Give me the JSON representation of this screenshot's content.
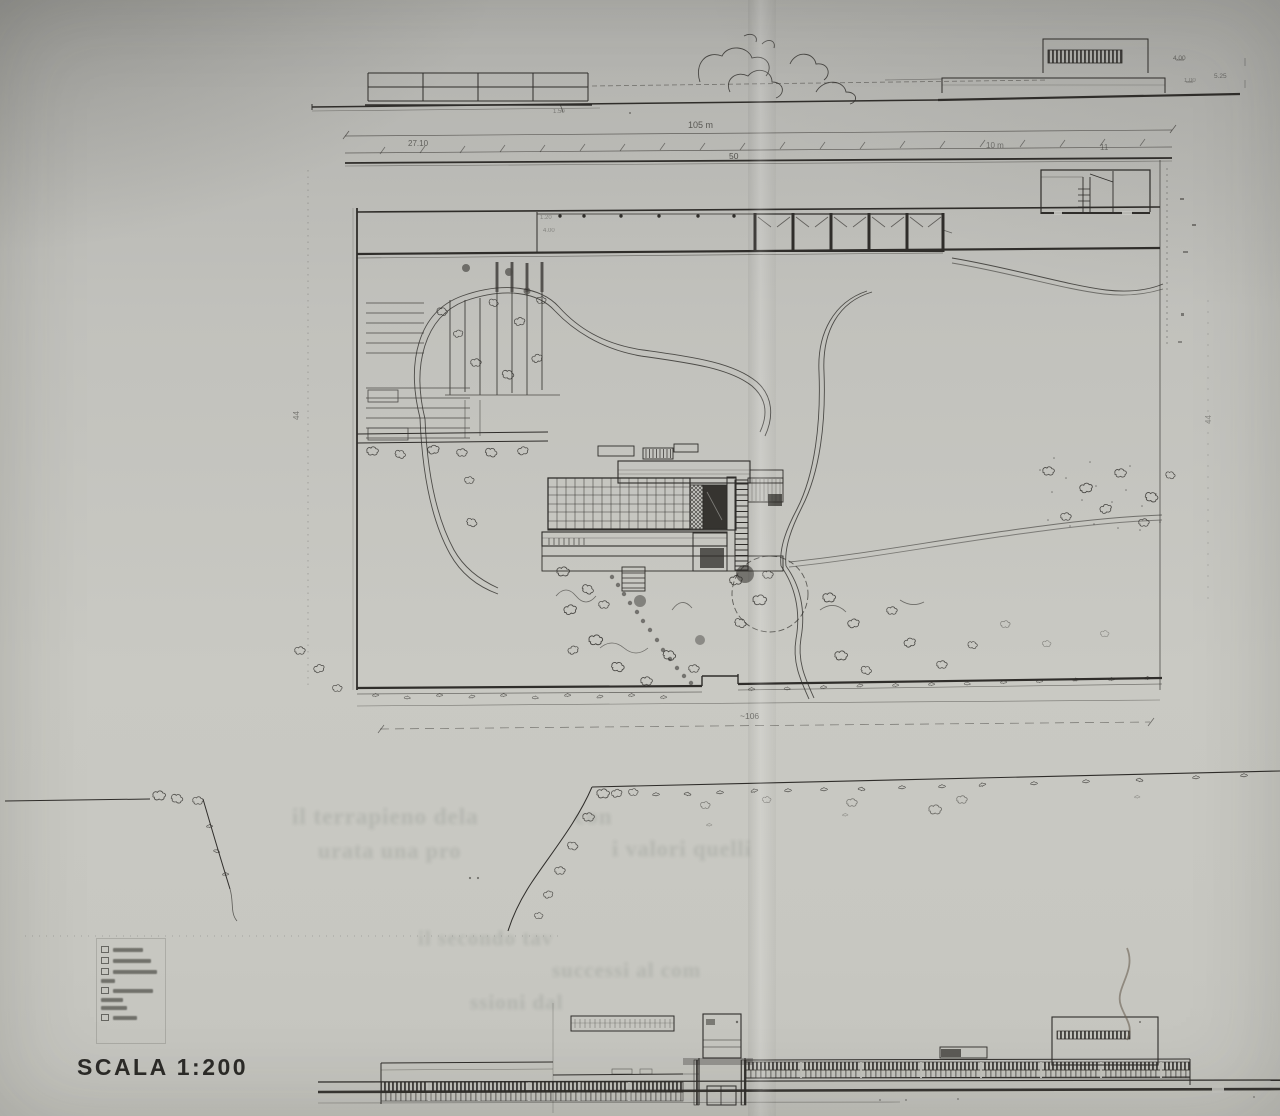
{
  "page": {
    "scale_label": "SCALA 1:200",
    "paper_color": "#c6c6c1",
    "ink_color": "#2f2d2a"
  },
  "site_plan": {
    "overall_width_dim": "105 m",
    "left_segment_dim": "27.10",
    "mid_segment_dim": "50",
    "right_segment_dim": "10 m",
    "far_right_segment_dim": "11",
    "bottom_overall_dim": "~106",
    "side_depth_dim": "44"
  },
  "annotations": [
    {
      "text": "105 m",
      "x": 688,
      "y": 120,
      "fs": 9,
      "op": 0.7
    },
    {
      "text": "27.10",
      "x": 408,
      "y": 139,
      "fs": 8,
      "op": 0.65
    },
    {
      "text": "50",
      "x": 729,
      "y": 151,
      "fs": 8.5,
      "op": 0.75
    },
    {
      "text": "10 m",
      "x": 986,
      "y": 141,
      "fs": 8,
      "op": 0.55
    },
    {
      "text": "11",
      "x": 1100,
      "y": 143,
      "fs": 8,
      "op": 0.55
    },
    {
      "text": "~106",
      "x": 740,
      "y": 711,
      "fs": 8.5,
      "op": 0.6
    },
    {
      "text": "44",
      "x": 292,
      "y": 420,
      "fs": 8,
      "op": 0.5,
      "rot": -90
    },
    {
      "text": "44",
      "x": 1204,
      "y": 424,
      "fs": 8,
      "op": 0.38,
      "rot": -90
    },
    {
      "text": "4.00",
      "x": 1173,
      "y": 55,
      "fs": 6.5,
      "op": 0.6
    },
    {
      "text": "5.25",
      "x": 1214,
      "y": 73,
      "fs": 6.5,
      "op": 0.55
    },
    {
      "text": "1.00",
      "x": 1184,
      "y": 78,
      "fs": 6,
      "op": 0.45
    },
    {
      "text": "1.50",
      "x": 553,
      "y": 109,
      "fs": 6,
      "op": 0.45
    },
    {
      "text": "1.20",
      "x": 540,
      "y": 215,
      "fs": 6,
      "op": 0.42
    },
    {
      "text": "4.00",
      "x": 543,
      "y": 228,
      "fs": 6,
      "op": 0.4
    }
  ],
  "ghost_text": {
    "lines": [
      {
        "text": "il terrapieno dela",
        "x": 292,
        "y": 804,
        "fs": 23
      },
      {
        "text": "con",
        "x": 575,
        "y": 804,
        "fs": 23
      },
      {
        "text": "urata una pro",
        "x": 318,
        "y": 838,
        "fs": 22
      },
      {
        "text": "i valori quelli",
        "x": 612,
        "y": 836,
        "fs": 22
      },
      {
        "text": "il secondo tav",
        "x": 418,
        "y": 926,
        "fs": 21
      },
      {
        "text": "successi al com",
        "x": 552,
        "y": 958,
        "fs": 21
      },
      {
        "text": "ssioni dal",
        "x": 470,
        "y": 990,
        "fs": 21
      }
    ]
  },
  "legend": {
    "rows": [
      {
        "box": true,
        "w": 30
      },
      {
        "box": true,
        "w": 38
      },
      {
        "box": true,
        "w": 44
      },
      {
        "box": false,
        "w": 14
      },
      {
        "box": true,
        "w": 40
      },
      {
        "box": false,
        "w": 22
      },
      {
        "box": false,
        "w": 26
      },
      {
        "box": true,
        "w": 24
      }
    ]
  }
}
